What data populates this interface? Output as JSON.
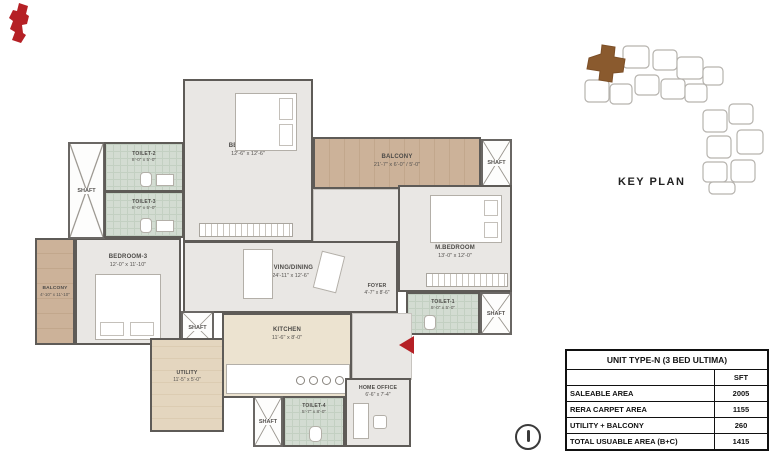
{
  "shaft_label": "SHAFT",
  "rooms": {
    "bedroom2": {
      "name": "BEDROOM-2",
      "dims": "12'-6\" x 12'-6\""
    },
    "toilet2": {
      "name": "TOILET-2",
      "dims": "8'-0\" x 5'-0\""
    },
    "toilet3": {
      "name": "TOILET-3",
      "dims": "8'-0\" x 5'-0\""
    },
    "balcony_top": {
      "name": "BALCONY",
      "dims": "21'-7\" x 6'-0\" / 5'-0\""
    },
    "living": {
      "name": "LIVING/DINING",
      "dims": "24'-11\" x 12'-6\""
    },
    "foyer": {
      "name": "FOYER",
      "dims": "4'-7\" x 8'-6\""
    },
    "mbedroom": {
      "name": "M.BEDROOM",
      "dims": "13'-0\" x 12'-0\""
    },
    "toilet1": {
      "name": "TOILET-1",
      "dims": "9'-0\" x 5'-0\""
    },
    "kitchen": {
      "name": "KITCHEN",
      "dims": "11'-6\" x 8'-0\""
    },
    "utility": {
      "name": "UTILITY",
      "dims": "11'-5\" x 5'-0\""
    },
    "home_office": {
      "name": "HOME OFFICE",
      "dims": "6'-6\" x 7'-4\""
    },
    "toilet4": {
      "name": "TOILET-4",
      "dims": "5'-7\" x 8'-0\""
    },
    "bedroom3": {
      "name": "BEDROOM-3",
      "dims": "12'-0\" x 11'-10\""
    },
    "balcony_left": {
      "name": "BALCONY",
      "dims": "4'-10\" x 11'-10\""
    }
  },
  "key_plan": {
    "label": "KEY PLAN"
  },
  "area_table": {
    "title": "UNIT TYPE-N (3 BED ULTIMA)",
    "unit_header": "SFT",
    "rows": [
      {
        "label": "SALEABLE AREA",
        "value": "2005"
      },
      {
        "label": "RERA CARPET AREA",
        "value": "1155"
      },
      {
        "label": "UTILITY + BALCONY",
        "value": "260"
      },
      {
        "label": "TOTAL USUABLE AREA (B+C)",
        "value": "1415"
      }
    ]
  },
  "colors": {
    "accent_red": "#b52025",
    "keyplan_unit_brown": "#8a5a2e",
    "wall_gray": "#5e5b57"
  }
}
